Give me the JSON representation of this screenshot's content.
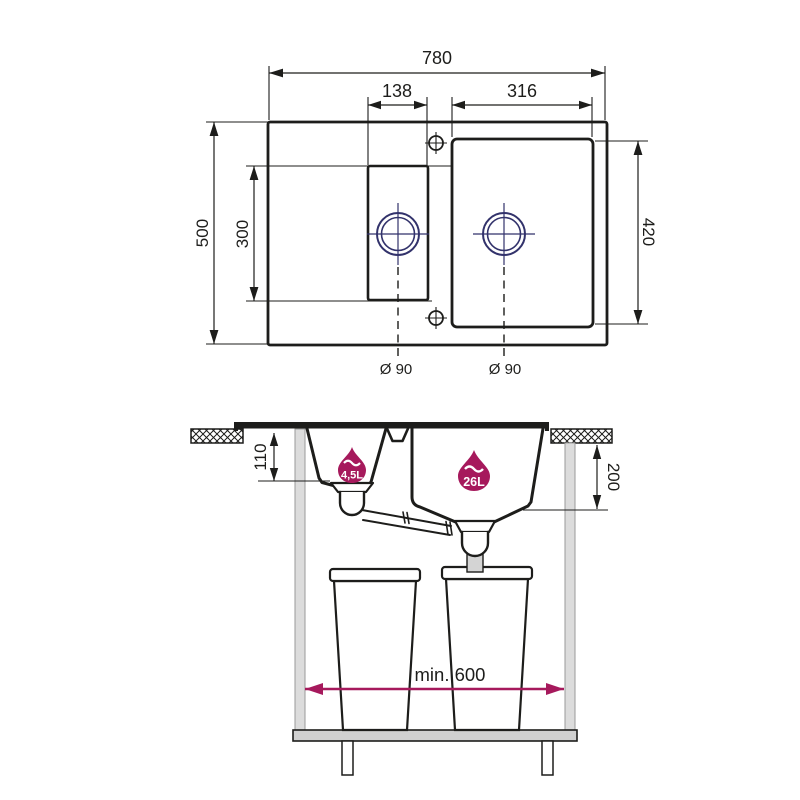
{
  "top_view": {
    "overall_width": "780",
    "small_bowl_width": "138",
    "large_bowl_width": "316",
    "overall_depth": "500",
    "small_bowl_depth": "300",
    "large_bowl_depth": "420",
    "small_drain_diameter": "Ø 90",
    "large_drain_diameter": "Ø 90"
  },
  "section_view": {
    "small_bowl_height": "110",
    "large_bowl_height": "200",
    "small_bowl_capacity": "4,5L",
    "large_bowl_capacity": "26L",
    "cabinet_min_width": "min. 600"
  },
  "colors": {
    "line": "#1d1d1b",
    "drain_blue": "#32326b",
    "accent_magenta": "#a6195c",
    "cabinet_gray": "#dcdcdc"
  }
}
